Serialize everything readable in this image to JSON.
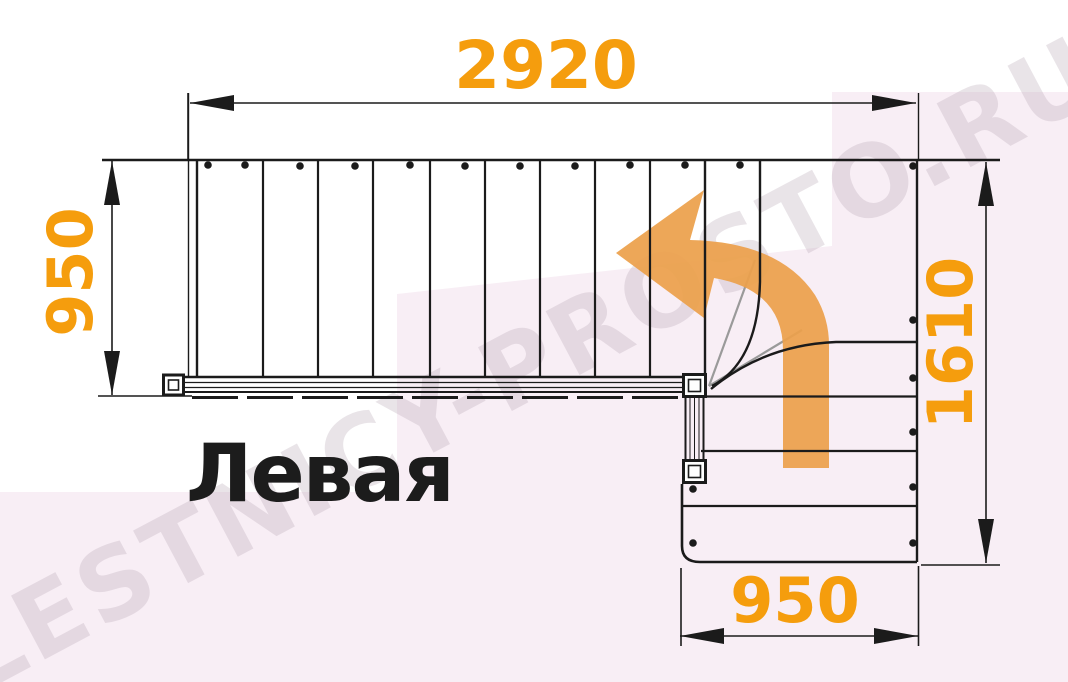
{
  "diagram": {
    "label": "Левая",
    "watermark": "LESTNICY-PROSTO.RU",
    "dimensions": {
      "top_width": "2920",
      "left_height": "950",
      "right_height": "1610",
      "bottom_width": "950"
    },
    "stairs": {
      "type": "L-shaped staircase plan, top view",
      "turn_direction": "left",
      "straight_treads_upper_flight": 9,
      "winder_treads": 3,
      "straight_treads_lower_flight": 3
    }
  },
  "colors": {
    "dimension_text": "#F59D0D",
    "arrow_fill": "#ECA04B",
    "ink": "#1B1B1B",
    "secondary_line": "#9A9A9A",
    "background_tint": "#F8EEF5",
    "watermark_text": "rgba(186,172,183,0.32)",
    "label_text": "#1C1C1C"
  }
}
